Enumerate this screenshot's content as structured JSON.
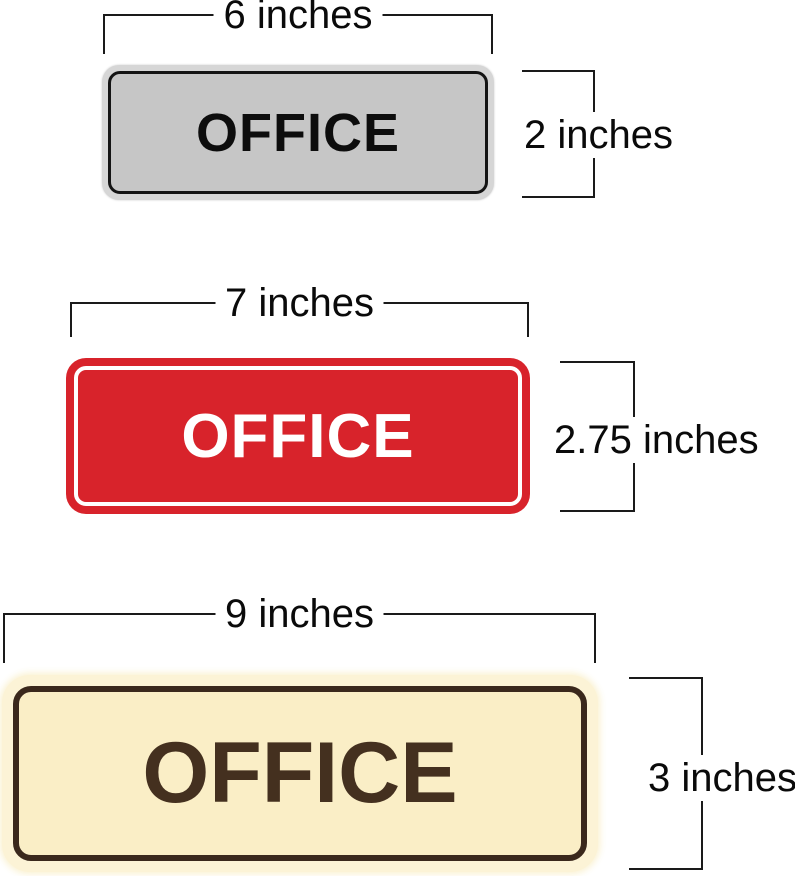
{
  "page": {
    "background": "#ffffff",
    "dimension_line_color": "#1a1a1a",
    "dimension_text_color": "#0a0a0a"
  },
  "signs": [
    {
      "name": "silver-office-sign",
      "label": "OFFICE",
      "width_label": "6 inches",
      "height_label": "2 inches",
      "colors": {
        "frame": "#d6d6d6",
        "face": "#c6c6c6",
        "line": "#141414",
        "text": "#0d0d0d"
      }
    },
    {
      "name": "red-office-sign",
      "label": "OFFICE",
      "width_label": "7 inches",
      "height_label": "2.75 inches",
      "colors": {
        "frame": "#d8232b",
        "face": "#d8232b",
        "line": "#ffffff",
        "text": "#ffffff"
      }
    },
    {
      "name": "cream-office-sign",
      "label": "OFFICE",
      "width_label": "9 inches",
      "height_label": "3 inches",
      "colors": {
        "frame": "#fcf3d6",
        "face": "#faeec6",
        "line": "#3a281c",
        "text": "#44301f"
      }
    }
  ]
}
